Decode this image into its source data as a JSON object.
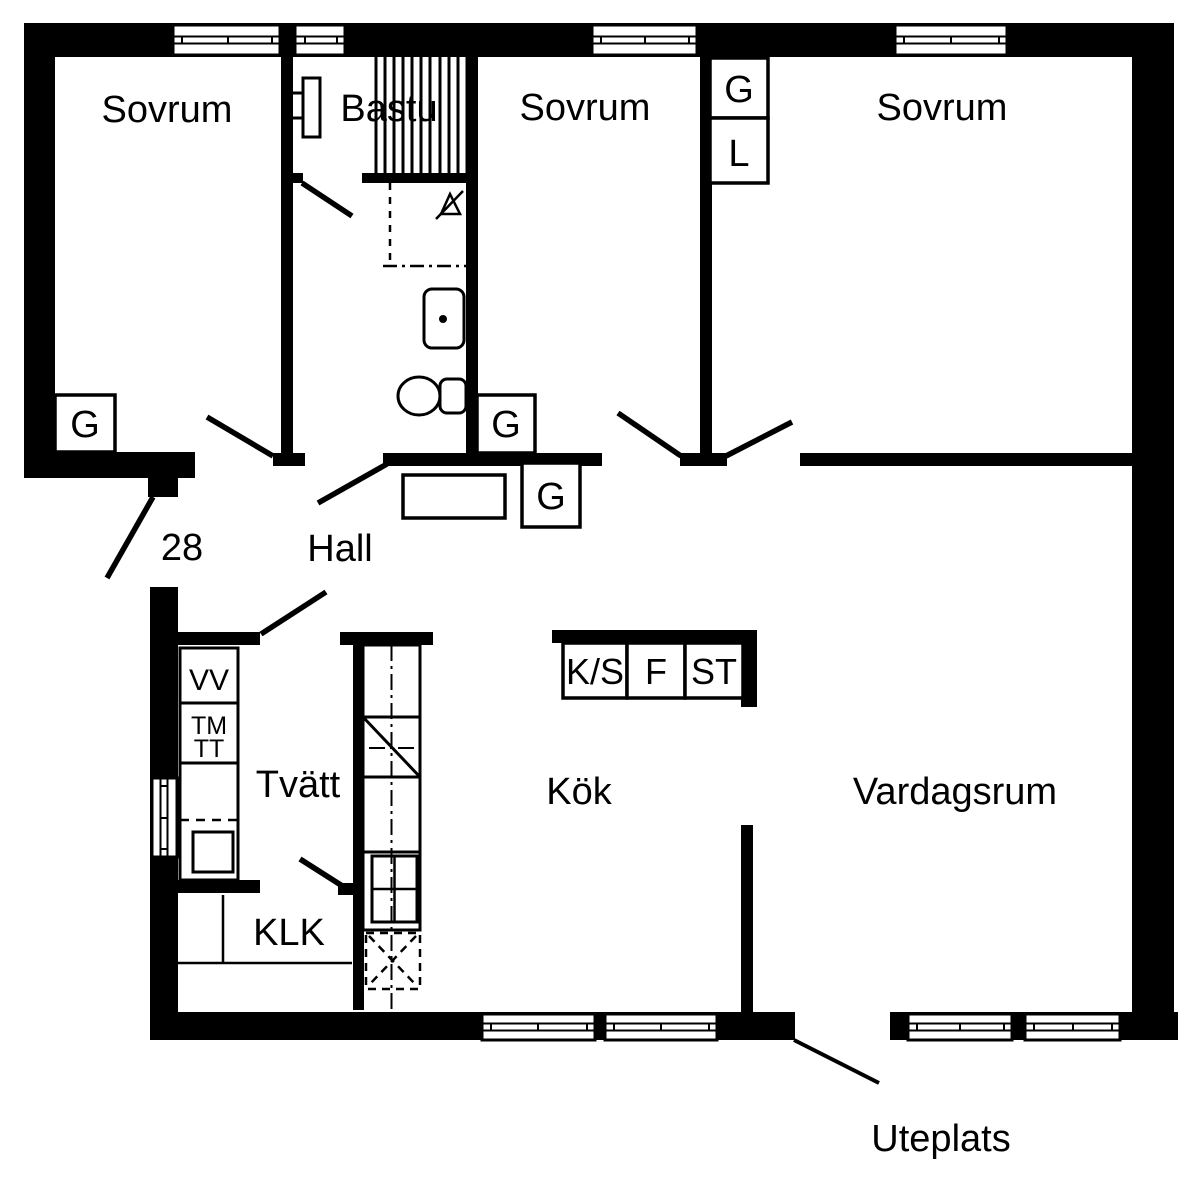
{
  "plan": {
    "type": "apartment floor plan",
    "apartment_number": "28",
    "rooms": {
      "bedroom_left": "Sovrum",
      "sauna": "Bastu",
      "bedroom_middle": "Sovrum",
      "bedroom_right": "Sovrum",
      "hall": "Hall",
      "laundry": "Tvätt",
      "closet_room": "KLK",
      "kitchen": "Kök",
      "living_room": "Vardagsrum",
      "patio": "Uteplats"
    },
    "fixtures": {
      "wardrobe": "G",
      "linen_cabinet": "L",
      "water_heater": "VV",
      "washing_machine": "TM",
      "tumble_dryer": "TT",
      "fridge_cooler": "K/S",
      "freezer": "F",
      "cleaning_closet": "ST"
    },
    "colors": {
      "wall": "#000000",
      "background": "#ffffff"
    }
  }
}
